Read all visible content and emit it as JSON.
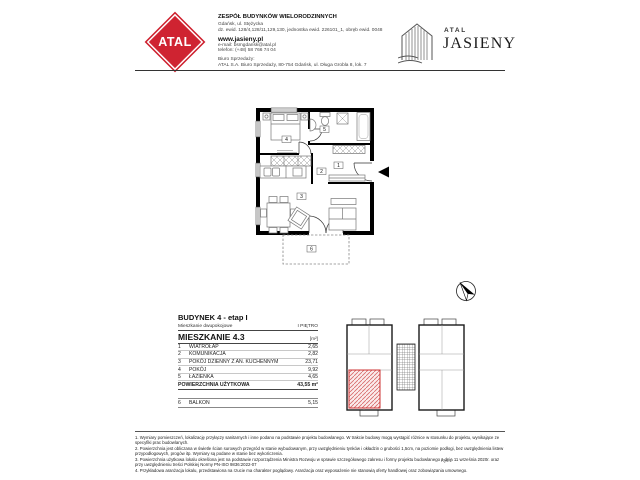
{
  "header": {
    "logo": "ATAL",
    "title": "ZESPÓŁ BUDYNKÓW WIELORODZINNYCH",
    "address_line1": "Gdańsk, ul. Stężycka",
    "address_line2": "dz. ewid. 128/4,128/11,129,130, jednostka ewid. 226101_1, obręb ewid. 0048",
    "website": "www.jasieny.pl",
    "email": "e-mail: bsmgdansk@atal.pl",
    "phone": "telefon: (+48) 58 766 74 04",
    "office_label": "Biuro Sprzedaży:",
    "office_address": "ATAL S.A. Biuro Sprzedaży, 80-754 Gdańsk, ul. Długa Grobla 8, lok. 7",
    "brand_small": "ATAL",
    "brand_name": "JASIENY"
  },
  "plan": {
    "room_labels": [
      "1",
      "2",
      "3",
      "4",
      "5",
      "6"
    ]
  },
  "table": {
    "building": "BUDYNEK 4 - etap I",
    "apartment_type": "Mieszkanie dwupokojowe",
    "floor": "I PIĘTRO",
    "apartment": "MIESZKANIE 4.3",
    "unit": "[m²]",
    "rooms": [
      {
        "no": "1",
        "name": "WIATROŁAP",
        "area": "2,65"
      },
      {
        "no": "2",
        "name": "KOMUNIKACJA",
        "area": "2,82"
      },
      {
        "no": "3",
        "name": "POKÓJ DZIENNY Z AN. KUCHENNYM",
        "area": "23,71"
      },
      {
        "no": "4",
        "name": "POKÓJ",
        "area": "9,92"
      },
      {
        "no": "5",
        "name": "ŁAZIENKA",
        "area": "4,65"
      }
    ],
    "total_label": "POWIERZCHNIA UŻYTKOWA",
    "total_value": "43,55 m²",
    "balcony": {
      "no": "6",
      "name": "BALKON",
      "area": "5,15"
    }
  },
  "footnotes": [
    "1.  Wymiary pomieszczeń, lokalizację przyłączy sanitarnych i inne podano na podstawie projektu budowlanego. W trakcie budowy mogą wystąpić różnice w stosunku do projektu, wynikające ze specyfiki prac budowlanych.",
    "2.  Powierzchnia jest obliczana w świetle ścian surowych przegród w stanie wybudowanym, przy uwzględnieniu tynków i okładzin o grubości 1,5cm, na poziomie podłogi, bez uwzględnienia listew przypodłogowych, progów itp. Wymiary są podane w stanie bez wykończenia.",
    "3.  Powierzchnia użytkowa lokalu określona jest na podstawie rozporządzenia Ministra Rozwoju w sprawie szczegółowego zakresu i formy projektu budowlanego z dnia 11 września 2020r. oraz przy uwzględnieniu treści Polskiej Normy PN-ISO 9836:2022-07",
    "4.  Przykładowa aranżacja lokalu, przedstawiona na rzucie ma charakter poglądowy. Aranżacja oraz wyposażenie nie stanowią oferty handlowej oraz zobowiązania umownego."
  ],
  "drawing_number": "Rys.1",
  "colors": {
    "brand_red": "#cf2331",
    "unit_hatch_red": "#d66a6a",
    "wall_black": "#000000"
  }
}
